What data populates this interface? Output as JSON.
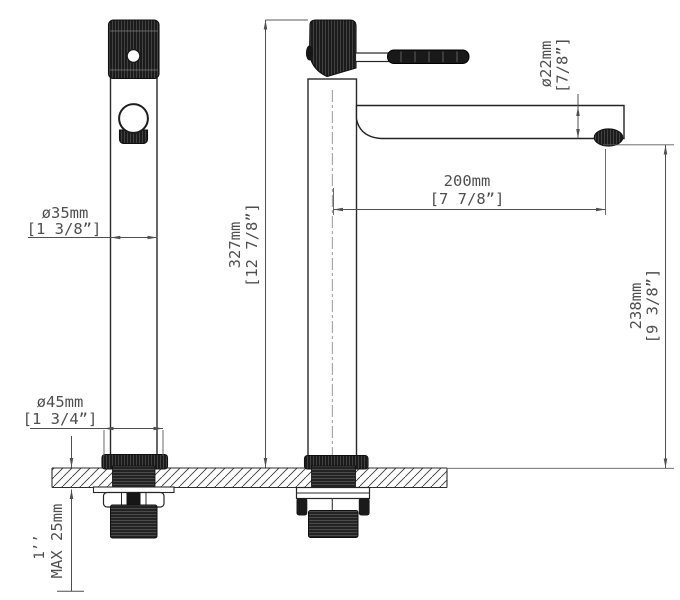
{
  "dims": {
    "body_diameter": {
      "metric": "ø35mm",
      "imperial": "[1  3/8”]"
    },
    "base_diameter": {
      "metric": "ø45mm",
      "imperial": "[1  3/4”]"
    },
    "overall_height": {
      "metric": "327mm",
      "imperial": "[12  7/8”]"
    },
    "spout_reach": {
      "metric": "200mm",
      "imperial": "[7  7/8”]"
    },
    "spout_diameter": {
      "metric": "ø22mm",
      "imperial": "[7/8”]"
    },
    "spout_height": {
      "metric": "238mm",
      "imperial": "[9  3/8”]"
    },
    "max_deck_thickness": "MAX 25mm",
    "thread_size": "1’’"
  },
  "colors": {
    "outline": "#282828",
    "dimension": "#4f4f4f",
    "dark_fill": "#1b1b1b",
    "background": "#ffffff"
  }
}
